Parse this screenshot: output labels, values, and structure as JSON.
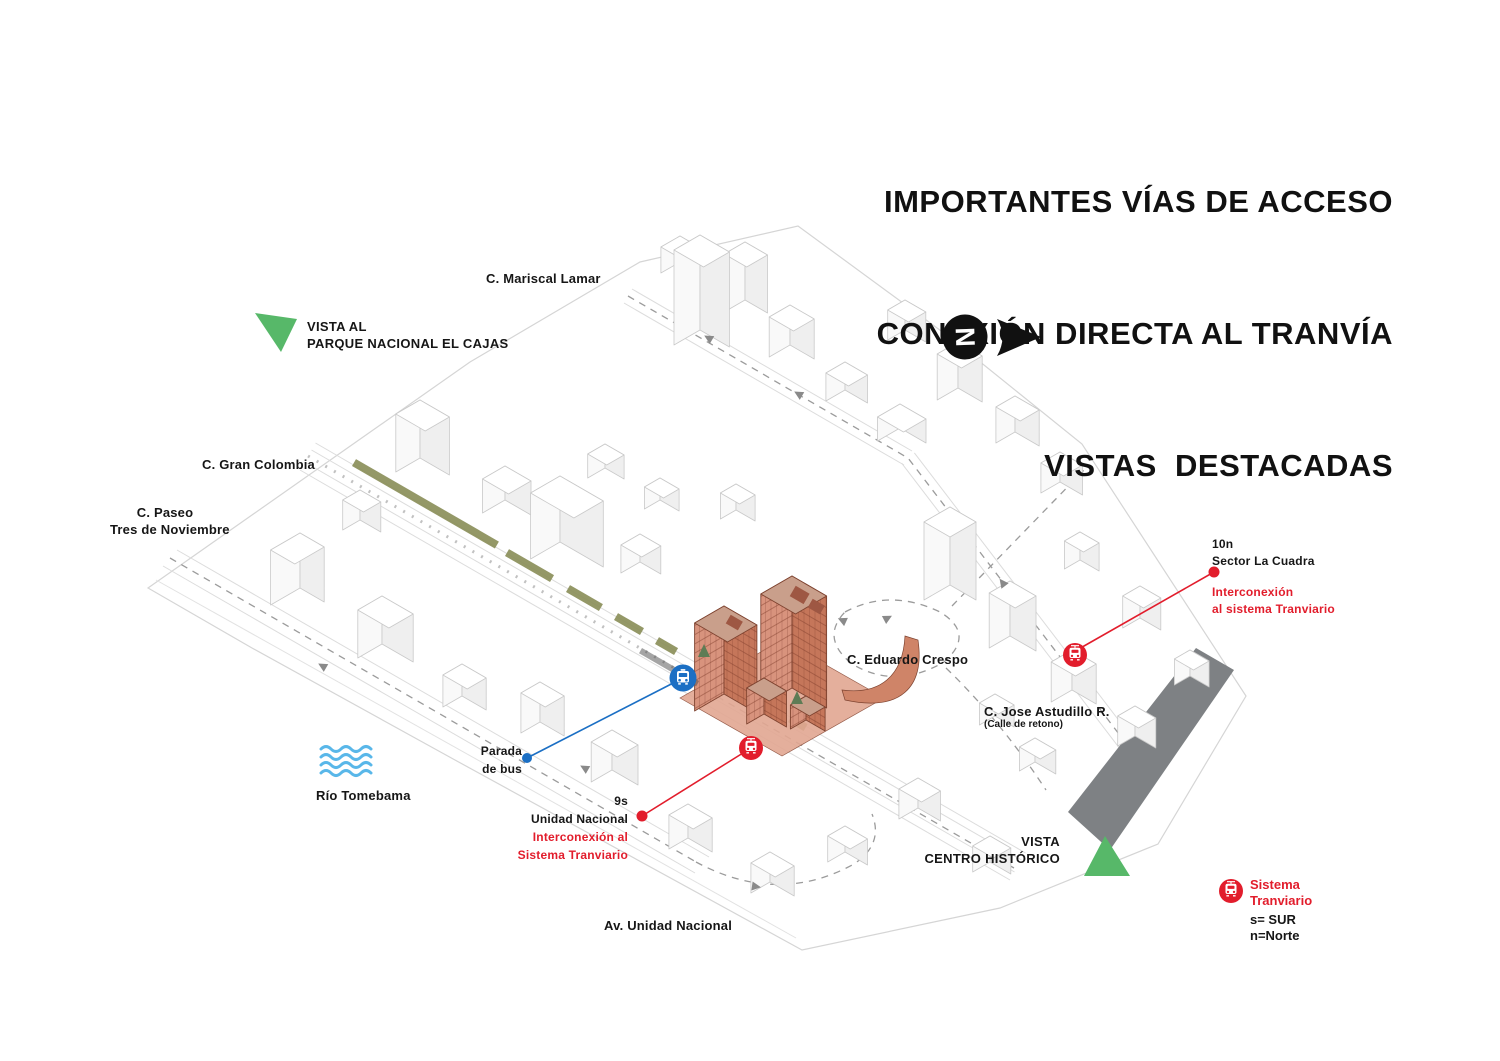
{
  "title": {
    "line1": "IMPORTANTES VÍAS DE ACCESO",
    "line2": "CONEXIÓN DIRECTA AL TRANVÍA",
    "line3": "VISTAS  DESTACADAS"
  },
  "north": {
    "letter": "N"
  },
  "vista_cajas": {
    "line1": "VISTA AL",
    "line2": "PARQUE NACIONAL EL CAJAS"
  },
  "vista_historico": {
    "line1": "VISTA",
    "line2": "CENTRO HISTÓRICO"
  },
  "streets": {
    "mariscal_lamar": "C. Mariscal Lamar",
    "gran_colombia": "C. Gran Colombia",
    "paseo_line1": "C. Paseo",
    "paseo_line2": "Tres de Noviembre",
    "eduardo_crespo": "C. Eduardo Crespo",
    "jose_astudillo": "C. Jose Astudillo R.",
    "jose_astudillo_note": "(Calle de retono)",
    "av_unidad_nacional": "Av. Unidad Nacional"
  },
  "river": {
    "name": "Río Tomebama"
  },
  "bus_stop": {
    "line1": "Parada",
    "line2": "de bus"
  },
  "tram_stop_sur": {
    "code": "9s",
    "name": "Unidad Nacional",
    "note_line1": "Interconexión al",
    "note_line2": "Sistema Tranviario"
  },
  "tram_stop_norte": {
    "code": "10n",
    "name": "Sector La Cuadra",
    "note_line1": "Interconexión",
    "note_line2": "al sistema Tranviario"
  },
  "legend": {
    "line1": "Sistema",
    "line2": "Tranviario",
    "south": "s= SUR",
    "north": "n=Norte"
  },
  "colors": {
    "red": "#e21d2c",
    "blue": "#1b6fc4",
    "green": "#57b869",
    "olive": "#8b8f5a",
    "terracotta": "#cd8064",
    "river": "#59b7e9",
    "gray_band": "#7e8184"
  }
}
